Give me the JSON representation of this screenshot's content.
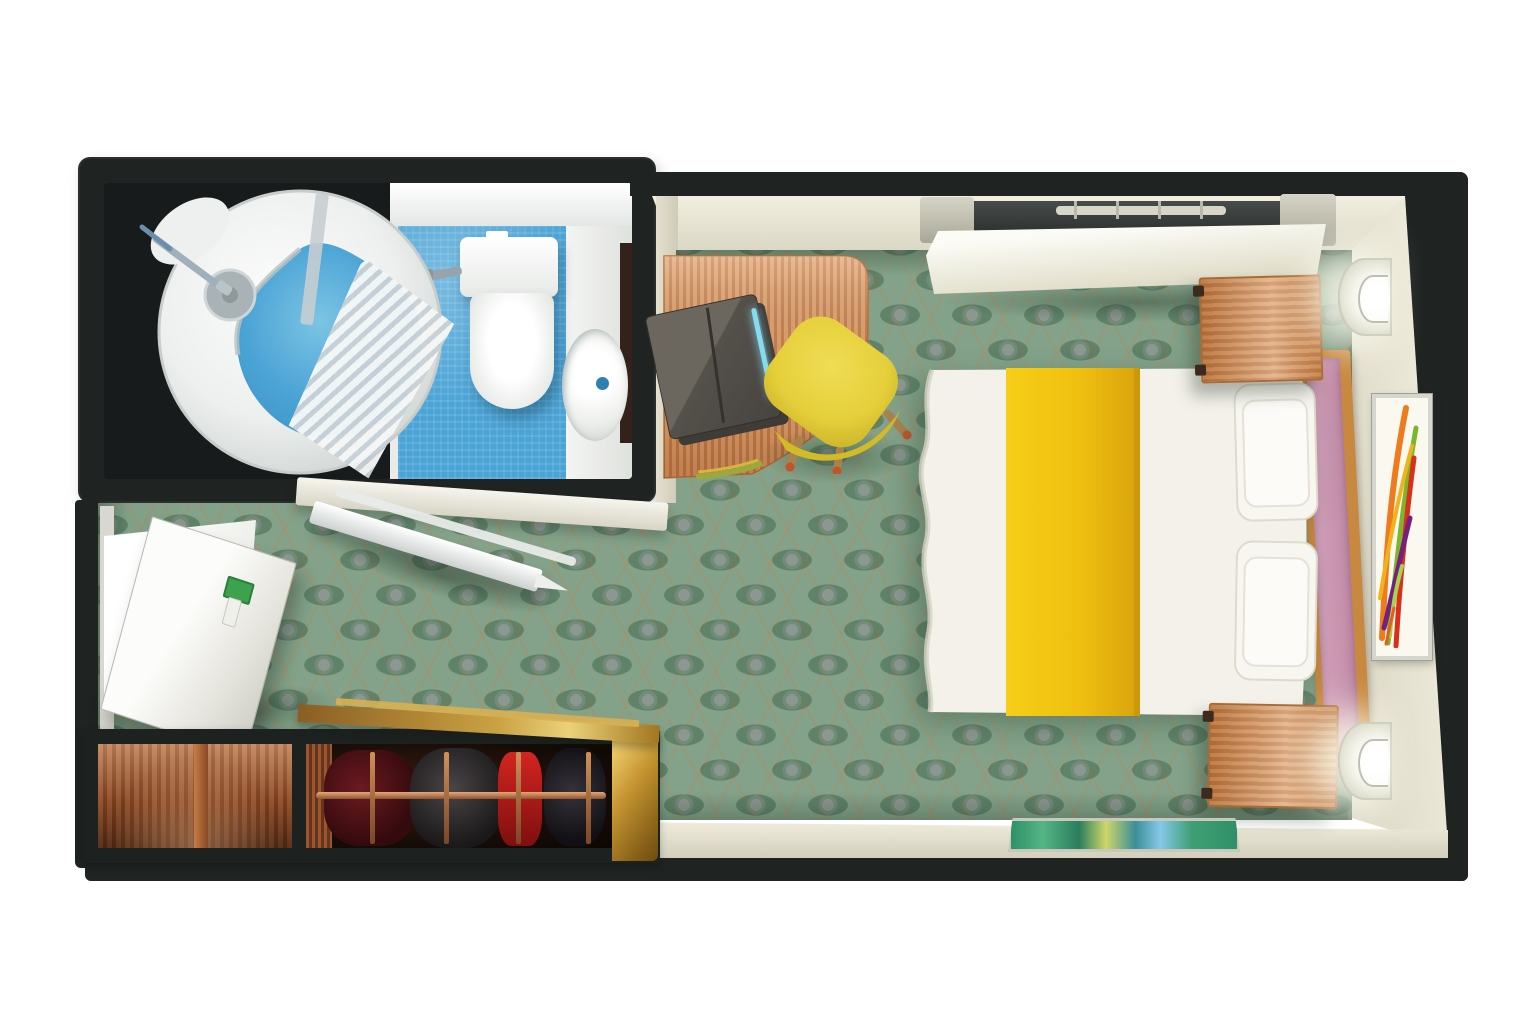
{
  "title": "Cruise stateroom floor plan — top-down 3D cutaway rendering",
  "palette": {
    "background": "#ffffff",
    "wall_black": "#1f2322",
    "wall_face_cream": "#e9e6d7",
    "carpet_green": "#83a289",
    "carpet_lattice_tan": "#a68e66",
    "carpet_medallion_gray": "#9b9ea0",
    "bathroom_tile_blue": "#4ba4d6",
    "fixture_white": "#f2f3f1",
    "desk_wood": "#dd9d68",
    "desk_wood_stripe": "#c67c45",
    "chair_yellow": "#e5cf3a",
    "bed_linen_white": "#f3f1e9",
    "bed_runner_yellow": "#f2c413",
    "headboard_pink": "#c794ae",
    "headboard_frame_wood": "#c8883f",
    "nightstand_wood": "#d18e55",
    "closet_gold": "#c59231",
    "closet_wood": "#a8613a",
    "garment_red": "#b51c19",
    "hanging_rod_copper": "#b97045",
    "laptop_bag_gray": "#55534e",
    "laptop_led_blue": "#7fd8ec",
    "lamp_glow_white": "#ffffff",
    "art_colors": [
      "#ee7b1e",
      "#7cb62c",
      "#d8301c",
      "#f2b21b",
      "#73217c",
      "#a8d44c"
    ]
  },
  "rooms": {
    "bathroom": {
      "label": "Bathroom with round shower pod, shower curtain, toilet and vanity sink on blue tile"
    },
    "bedroom": {
      "label": "Main cabin with double bed, yellow runner, desk, lounge chair, nightstands, wall lamps and artwork"
    },
    "entrance": {
      "label": "Entrance hallway with open door and key card"
    },
    "closet": {
      "label": "Cutaway wardrobe with shelves, hanging rail and garments"
    }
  }
}
